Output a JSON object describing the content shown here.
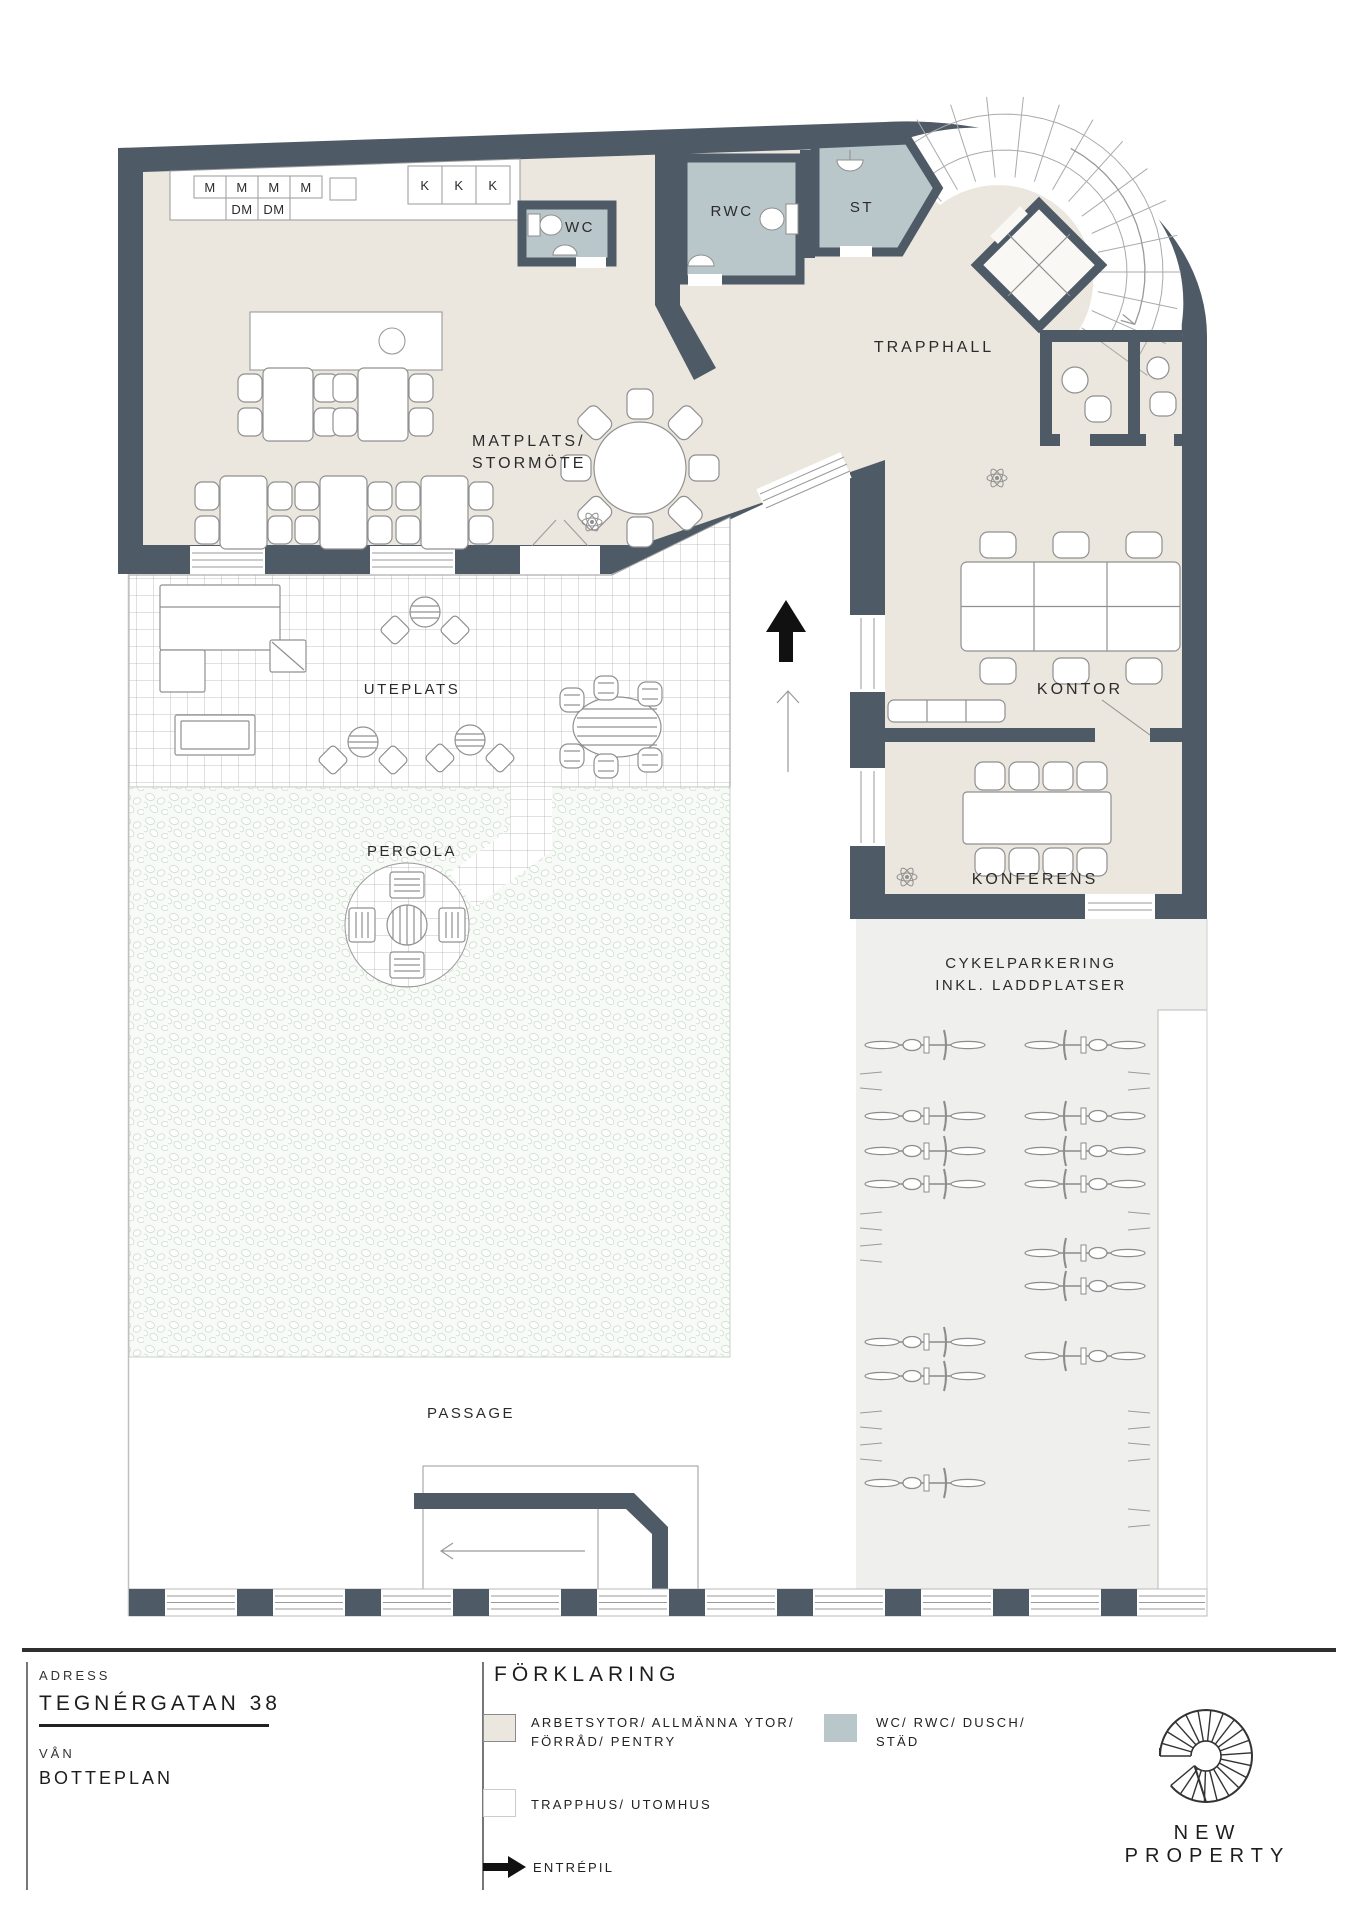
{
  "plan": {
    "kitchen": {
      "m1": "M",
      "m2": "M",
      "m3": "M",
      "m4": "M",
      "dm1": "DM",
      "dm2": "DM",
      "k1": "K",
      "k2": "K",
      "k3": "K"
    },
    "rooms": {
      "wc": "WC",
      "rwc": "RWC",
      "st": "ST",
      "trapphall": "TRAPPHALL",
      "matplats1": "MATPLATS/",
      "matplats2": "STORMÖTE",
      "kontor": "KONTOR",
      "konferens": "KONFERENS",
      "uteplats": "UTEPLATS",
      "pergola": "PERGOLA",
      "cykel1": "CYKELPARKERING",
      "cykel2": "INKL. LADDPLATSER",
      "passage": "PASSAGE"
    }
  },
  "footer": {
    "adress_label": "ADRESS",
    "adress_value": "TEGNÉRGATAN 38",
    "van_label": "VÅN",
    "van_value": "BOTTEPLAN",
    "forklaring": "FÖRKLARING",
    "legend_items": [
      {
        "line1": "ARBETSYTOR/ ALLMÄNNA YTOR/",
        "line2": "FÖRRÅD/ PENTRY"
      },
      {
        "line1": "WC/ RWC/ DUSCH/",
        "line2": "STÄD"
      },
      {
        "line1": "TRAPPHUS/ UTOMHUS",
        "line2": ""
      },
      {
        "line1": "ENTRÉPIL",
        "line2": ""
      }
    ],
    "brand": "NEW PROPERTY"
  },
  "colors": {
    "wall": "#4e5a66",
    "room": "#ebe7de",
    "wet": "#b9c6ca",
    "parking": "#efefee",
    "pebble_bg": "#f7faf6",
    "pebble_line": "#cadfca",
    "furniture_line": "#909090",
    "text": "#2b2b2b",
    "arrow": "#111111"
  }
}
